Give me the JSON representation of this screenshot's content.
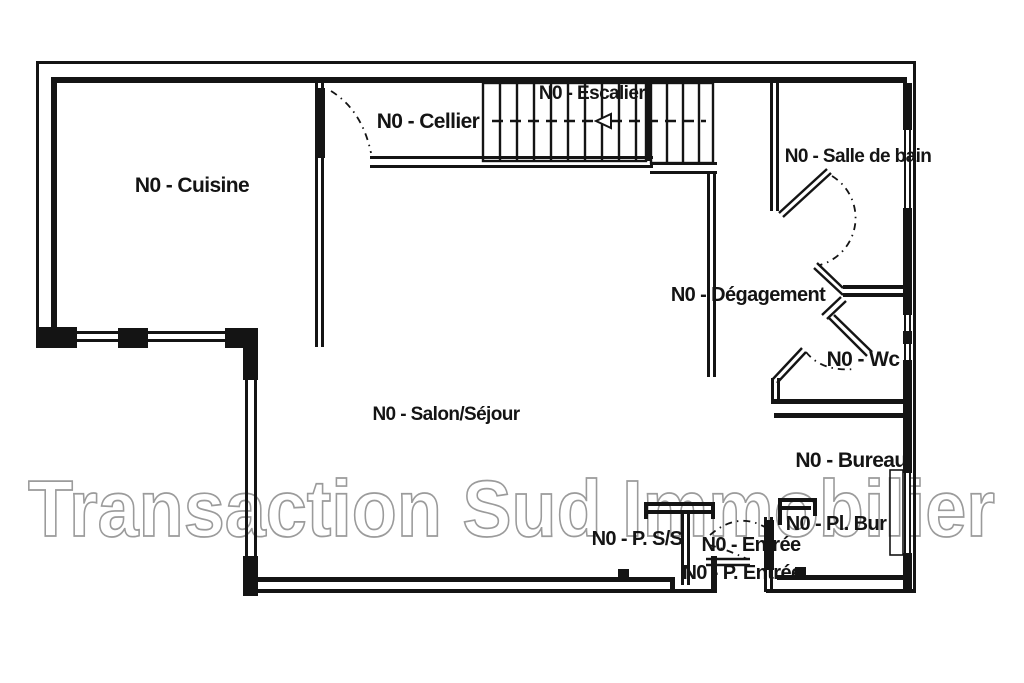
{
  "watermark": {
    "text": "Transaction Sud Immobilier",
    "color": "#9b9b9b"
  },
  "colors": {
    "ink": "#141414",
    "background": "#ffffff",
    "watermark_outline": "#9b9b9b"
  },
  "stairs": {
    "direction_arrow": "left",
    "treads_first_run": 10,
    "treads_second_run": 4
  },
  "rooms": [
    {
      "id": "cuisine",
      "label": "N0 - Cuisine"
    },
    {
      "id": "cellier",
      "label": "N0 - Cellier"
    },
    {
      "id": "escalier",
      "label": "N0 - Escalier"
    },
    {
      "id": "salle-de-bain",
      "label": "N0 - Salle de bain"
    },
    {
      "id": "degagement",
      "label": "N0 - Dégagement"
    },
    {
      "id": "wc",
      "label": "N0 - Wc"
    },
    {
      "id": "salon-sejour",
      "label": "N0 - Salon/Séjour"
    },
    {
      "id": "bureau",
      "label": "N0 - Bureau"
    },
    {
      "id": "pl-bur",
      "label": "N0 - Pl. Bur"
    },
    {
      "id": "p-ss",
      "label": "N0 - P. S/S"
    },
    {
      "id": "entree",
      "label": "N0 - Entrée"
    },
    {
      "id": "p-entree",
      "label": "N0 - P. Entrée"
    }
  ]
}
